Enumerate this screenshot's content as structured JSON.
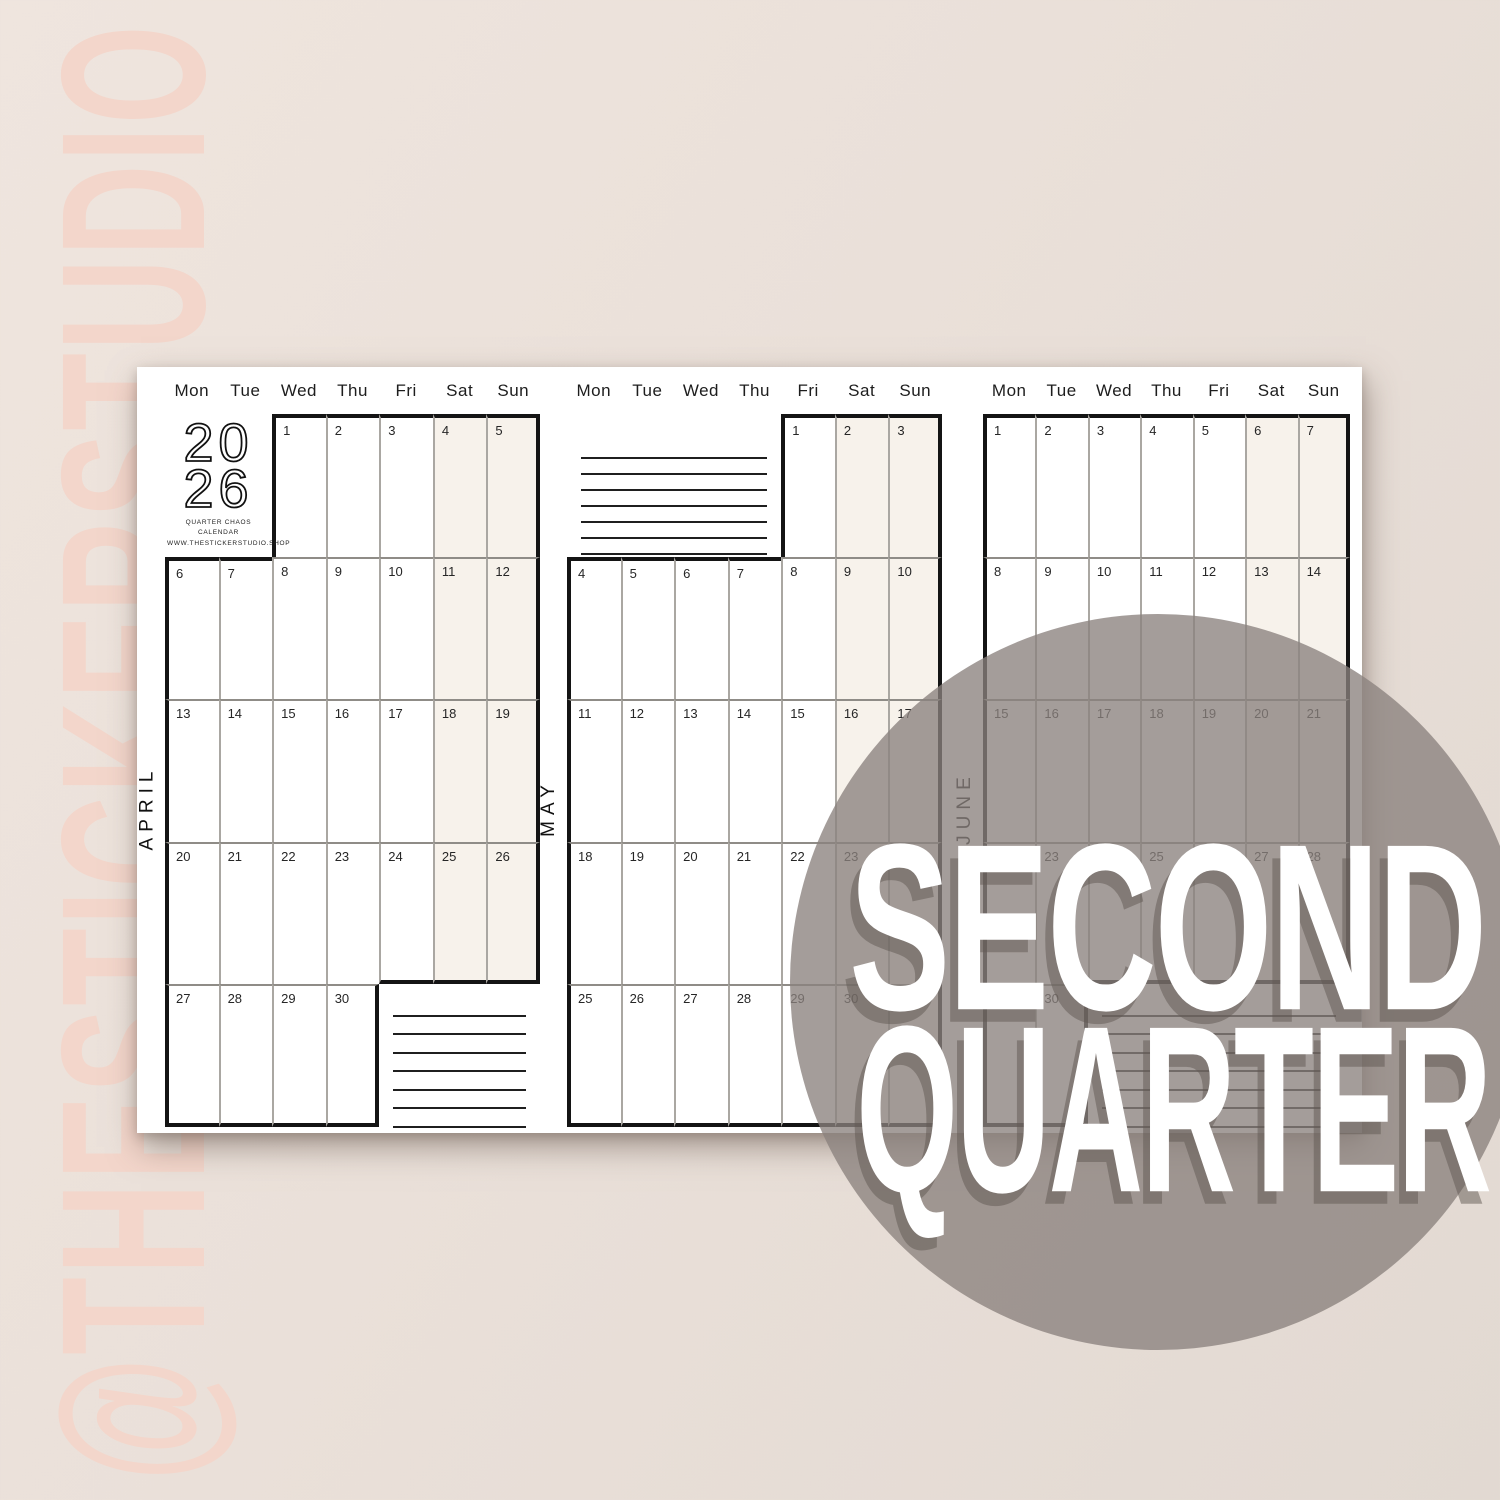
{
  "watermark": {
    "text": "@THESTICKERSTUDIO"
  },
  "overlay": {
    "line1": "SECOND",
    "line2": "QUARTER"
  },
  "sheet": {
    "day_headers": [
      "Mon",
      "Tue",
      "Wed",
      "Thu",
      "Fri",
      "Sat",
      "Sun"
    ],
    "logo": {
      "year_line1": "20",
      "year_line2": "26",
      "tagline1": "QUARTER CHAOS CALENDAR",
      "tagline2": "WWW.THESTICKERSTUDIO.SHOP"
    },
    "months": [
      {
        "label": "APRIL",
        "weeks": [
          [
            null,
            null,
            1,
            2,
            3,
            4,
            5
          ],
          [
            6,
            7,
            8,
            9,
            10,
            11,
            12
          ],
          [
            13,
            14,
            15,
            16,
            17,
            18,
            19
          ],
          [
            20,
            21,
            22,
            23,
            24,
            25,
            26
          ],
          [
            27,
            28,
            29,
            30,
            null,
            null,
            null
          ]
        ],
        "logo_area": {
          "row": 0,
          "cols": [
            0,
            1
          ]
        },
        "notes_area": {
          "row": 4,
          "cols": [
            4,
            6
          ]
        }
      },
      {
        "label": "MAY",
        "weeks": [
          [
            null,
            null,
            null,
            null,
            1,
            2,
            3
          ],
          [
            4,
            5,
            6,
            7,
            8,
            9,
            10
          ],
          [
            11,
            12,
            13,
            14,
            15,
            16,
            17
          ],
          [
            18,
            19,
            20,
            21,
            22,
            23,
            24
          ],
          [
            25,
            26,
            27,
            28,
            29,
            30,
            31
          ]
        ],
        "notes_area": {
          "row": 0,
          "cols": [
            0,
            3
          ]
        }
      },
      {
        "label": "JUNE",
        "weeks": [
          [
            1,
            2,
            3,
            4,
            5,
            6,
            7
          ],
          [
            8,
            9,
            10,
            11,
            12,
            13,
            14
          ],
          [
            15,
            16,
            17,
            18,
            19,
            20,
            21
          ],
          [
            22,
            23,
            24,
            25,
            26,
            27,
            28
          ],
          [
            29,
            30,
            null,
            null,
            null,
            null,
            null
          ]
        ],
        "notes_area": {
          "row": 4,
          "cols": [
            2,
            6
          ]
        }
      }
    ]
  },
  "colors": {
    "background": "#eae0d9",
    "watermark_pink": "#f3d6cb",
    "weekend_shade": "#f7f2eb",
    "grid_border_thick": "#141414",
    "grid_line_vertical": "#aaa7a2",
    "grid_line_horizontal": "#8f8c87",
    "note_line": "#1f1f1f",
    "circle_gray": "rgba(138,130,125,0.78)",
    "overlay_text": "#ffffff"
  }
}
